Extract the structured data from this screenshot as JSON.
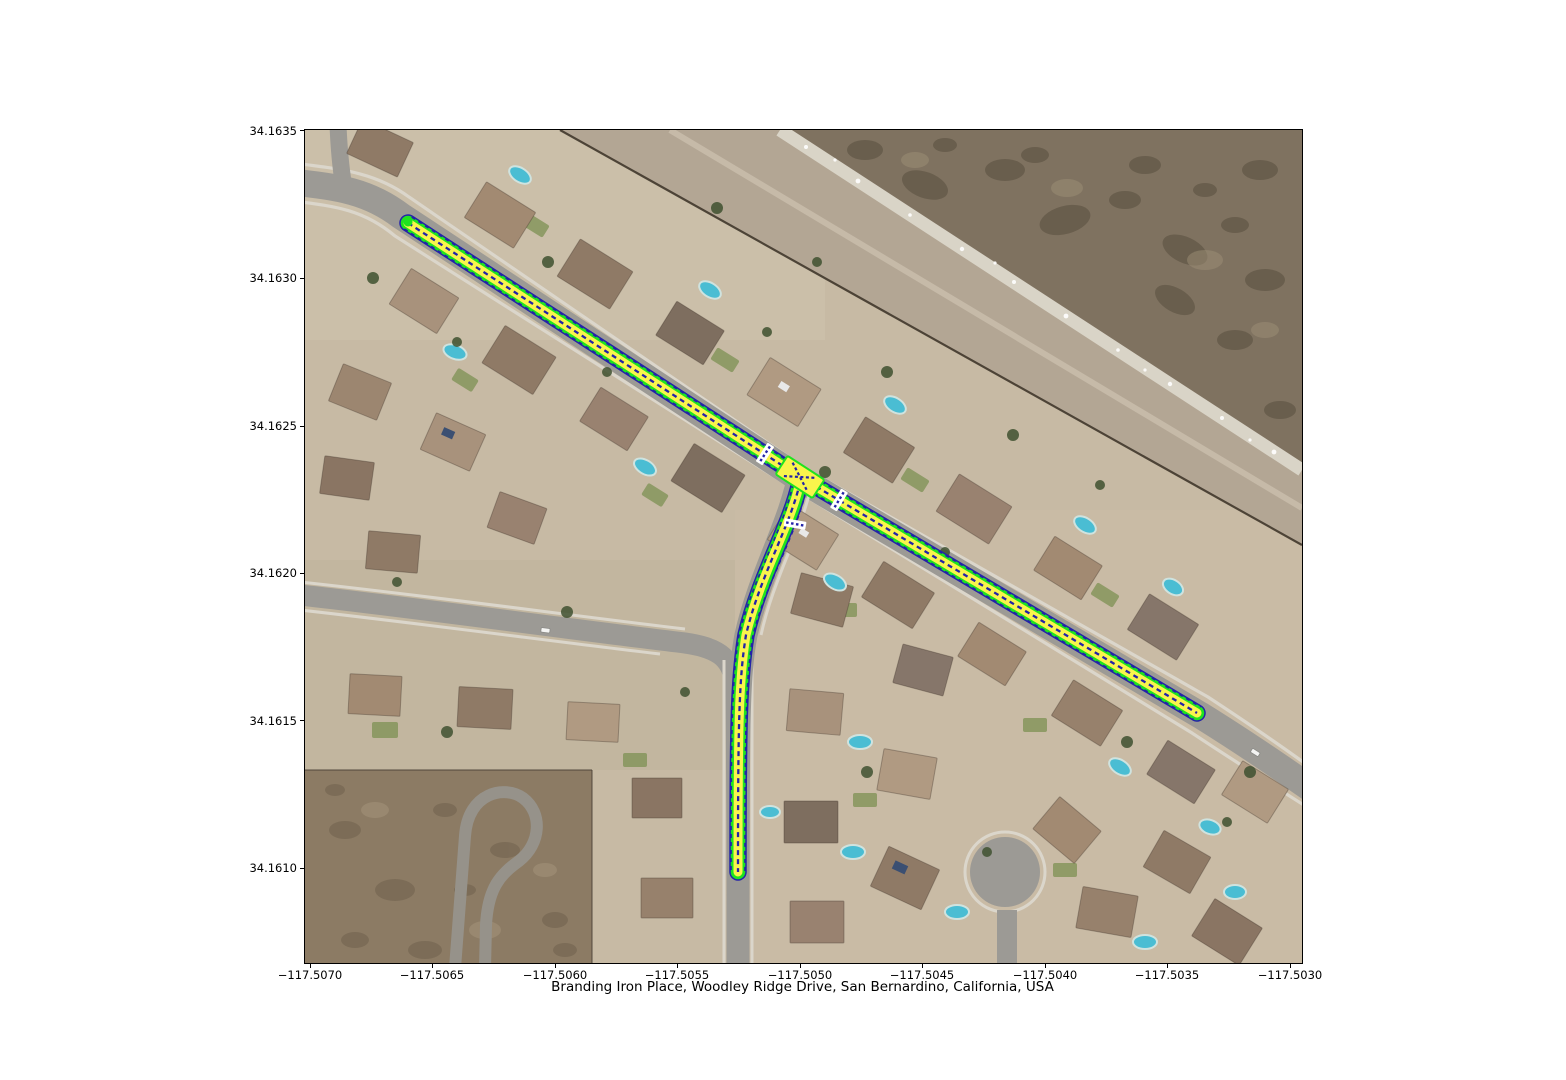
{
  "figure": {
    "title": "Branding Iron Place, Woodley Ridge Drive, San Bernardino, California, USA"
  },
  "axes": {
    "x_ticks": [
      "−117.5070",
      "−117.5065",
      "−117.5060",
      "−117.5055",
      "−117.5050",
      "−117.5045",
      "−117.5040",
      "−117.5035",
      "−117.5030"
    ],
    "y_ticks": [
      "34.1635",
      "34.1630",
      "34.1625",
      "34.1620",
      "34.1615",
      "34.1610"
    ]
  },
  "map": {
    "route_overlay_colors": {
      "casing": "#1fe31f",
      "fill": "#f9f44c",
      "lane_line": "#2323a8",
      "crosswalk": "#ffffff"
    }
  }
}
